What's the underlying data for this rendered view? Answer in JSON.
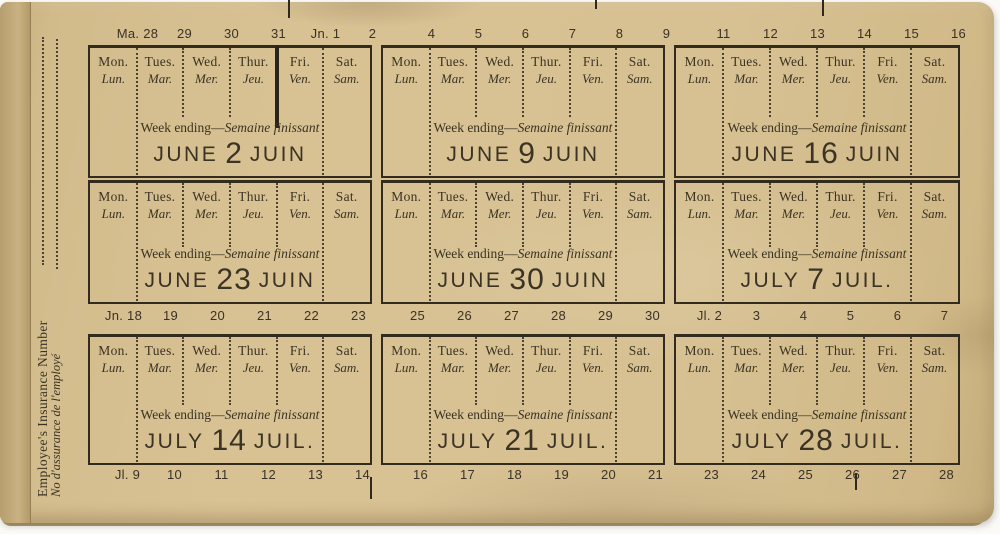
{
  "spine": {
    "label_en": "Employee's Insurance Number",
    "label_fr": "No d'assurance de l'employé"
  },
  "calendar": {
    "day_headers": {
      "en": [
        "Mon.",
        "Tues.",
        "Wed.",
        "Thur.",
        "Fri.",
        "Sat."
      ],
      "fr": [
        "Lun.",
        "Mar.",
        "Mer.",
        "Jeu.",
        "Ven.",
        "Sam."
      ]
    },
    "week_ending": {
      "en": "Week ending",
      "separator": "—",
      "fr": "Semaine finissant"
    },
    "weeks": [
      {
        "month_en": "JUNE",
        "day": "2",
        "month_fr": "JUIN",
        "month_boundary_after_day": 4
      },
      {
        "month_en": "JUNE",
        "day": "9",
        "month_fr": "JUIN"
      },
      {
        "month_en": "JUNE",
        "day": "16",
        "month_fr": "JUIN"
      },
      {
        "month_en": "JUNE",
        "day": "23",
        "month_fr": "JUIN"
      },
      {
        "month_en": "JUNE",
        "day": "30",
        "month_fr": "JUIN"
      },
      {
        "month_en": "JULY",
        "day": "7",
        "month_fr": "JUIL."
      },
      {
        "month_en": "JULY",
        "day": "14",
        "month_fr": "JUIL."
      },
      {
        "month_en": "JULY",
        "day": "21",
        "month_fr": "JUIL."
      },
      {
        "month_en": "JULY",
        "day": "28",
        "month_fr": "JUIL."
      }
    ],
    "date_strips": {
      "top": [
        [
          "Ma. 28",
          "29",
          "30",
          "31",
          "Jn. 1",
          "2"
        ],
        [
          "4",
          "5",
          "6",
          "7",
          "8",
          "9"
        ],
        [
          "11",
          "12",
          "13",
          "14",
          "15",
          "16"
        ]
      ],
      "middle": [
        [
          "Jn. 18",
          "19",
          "20",
          "21",
          "22",
          "23"
        ],
        [
          "25",
          "26",
          "27",
          "28",
          "29",
          "30"
        ],
        [
          "Jl. 2",
          "3",
          "4",
          "5",
          "6",
          "7"
        ]
      ],
      "bottom": [
        [
          "Jl. 9",
          "10",
          "11",
          "12",
          "13",
          "14"
        ],
        [
          "16",
          "17",
          "18",
          "19",
          "20",
          "21"
        ],
        [
          "23",
          "24",
          "25",
          "26",
          "27",
          "28"
        ]
      ]
    }
  },
  "colors": {
    "paper": "#d7c193",
    "paper_edge": "#c3ab79",
    "ink": "#3a3322",
    "background": "#fbfaf6"
  }
}
